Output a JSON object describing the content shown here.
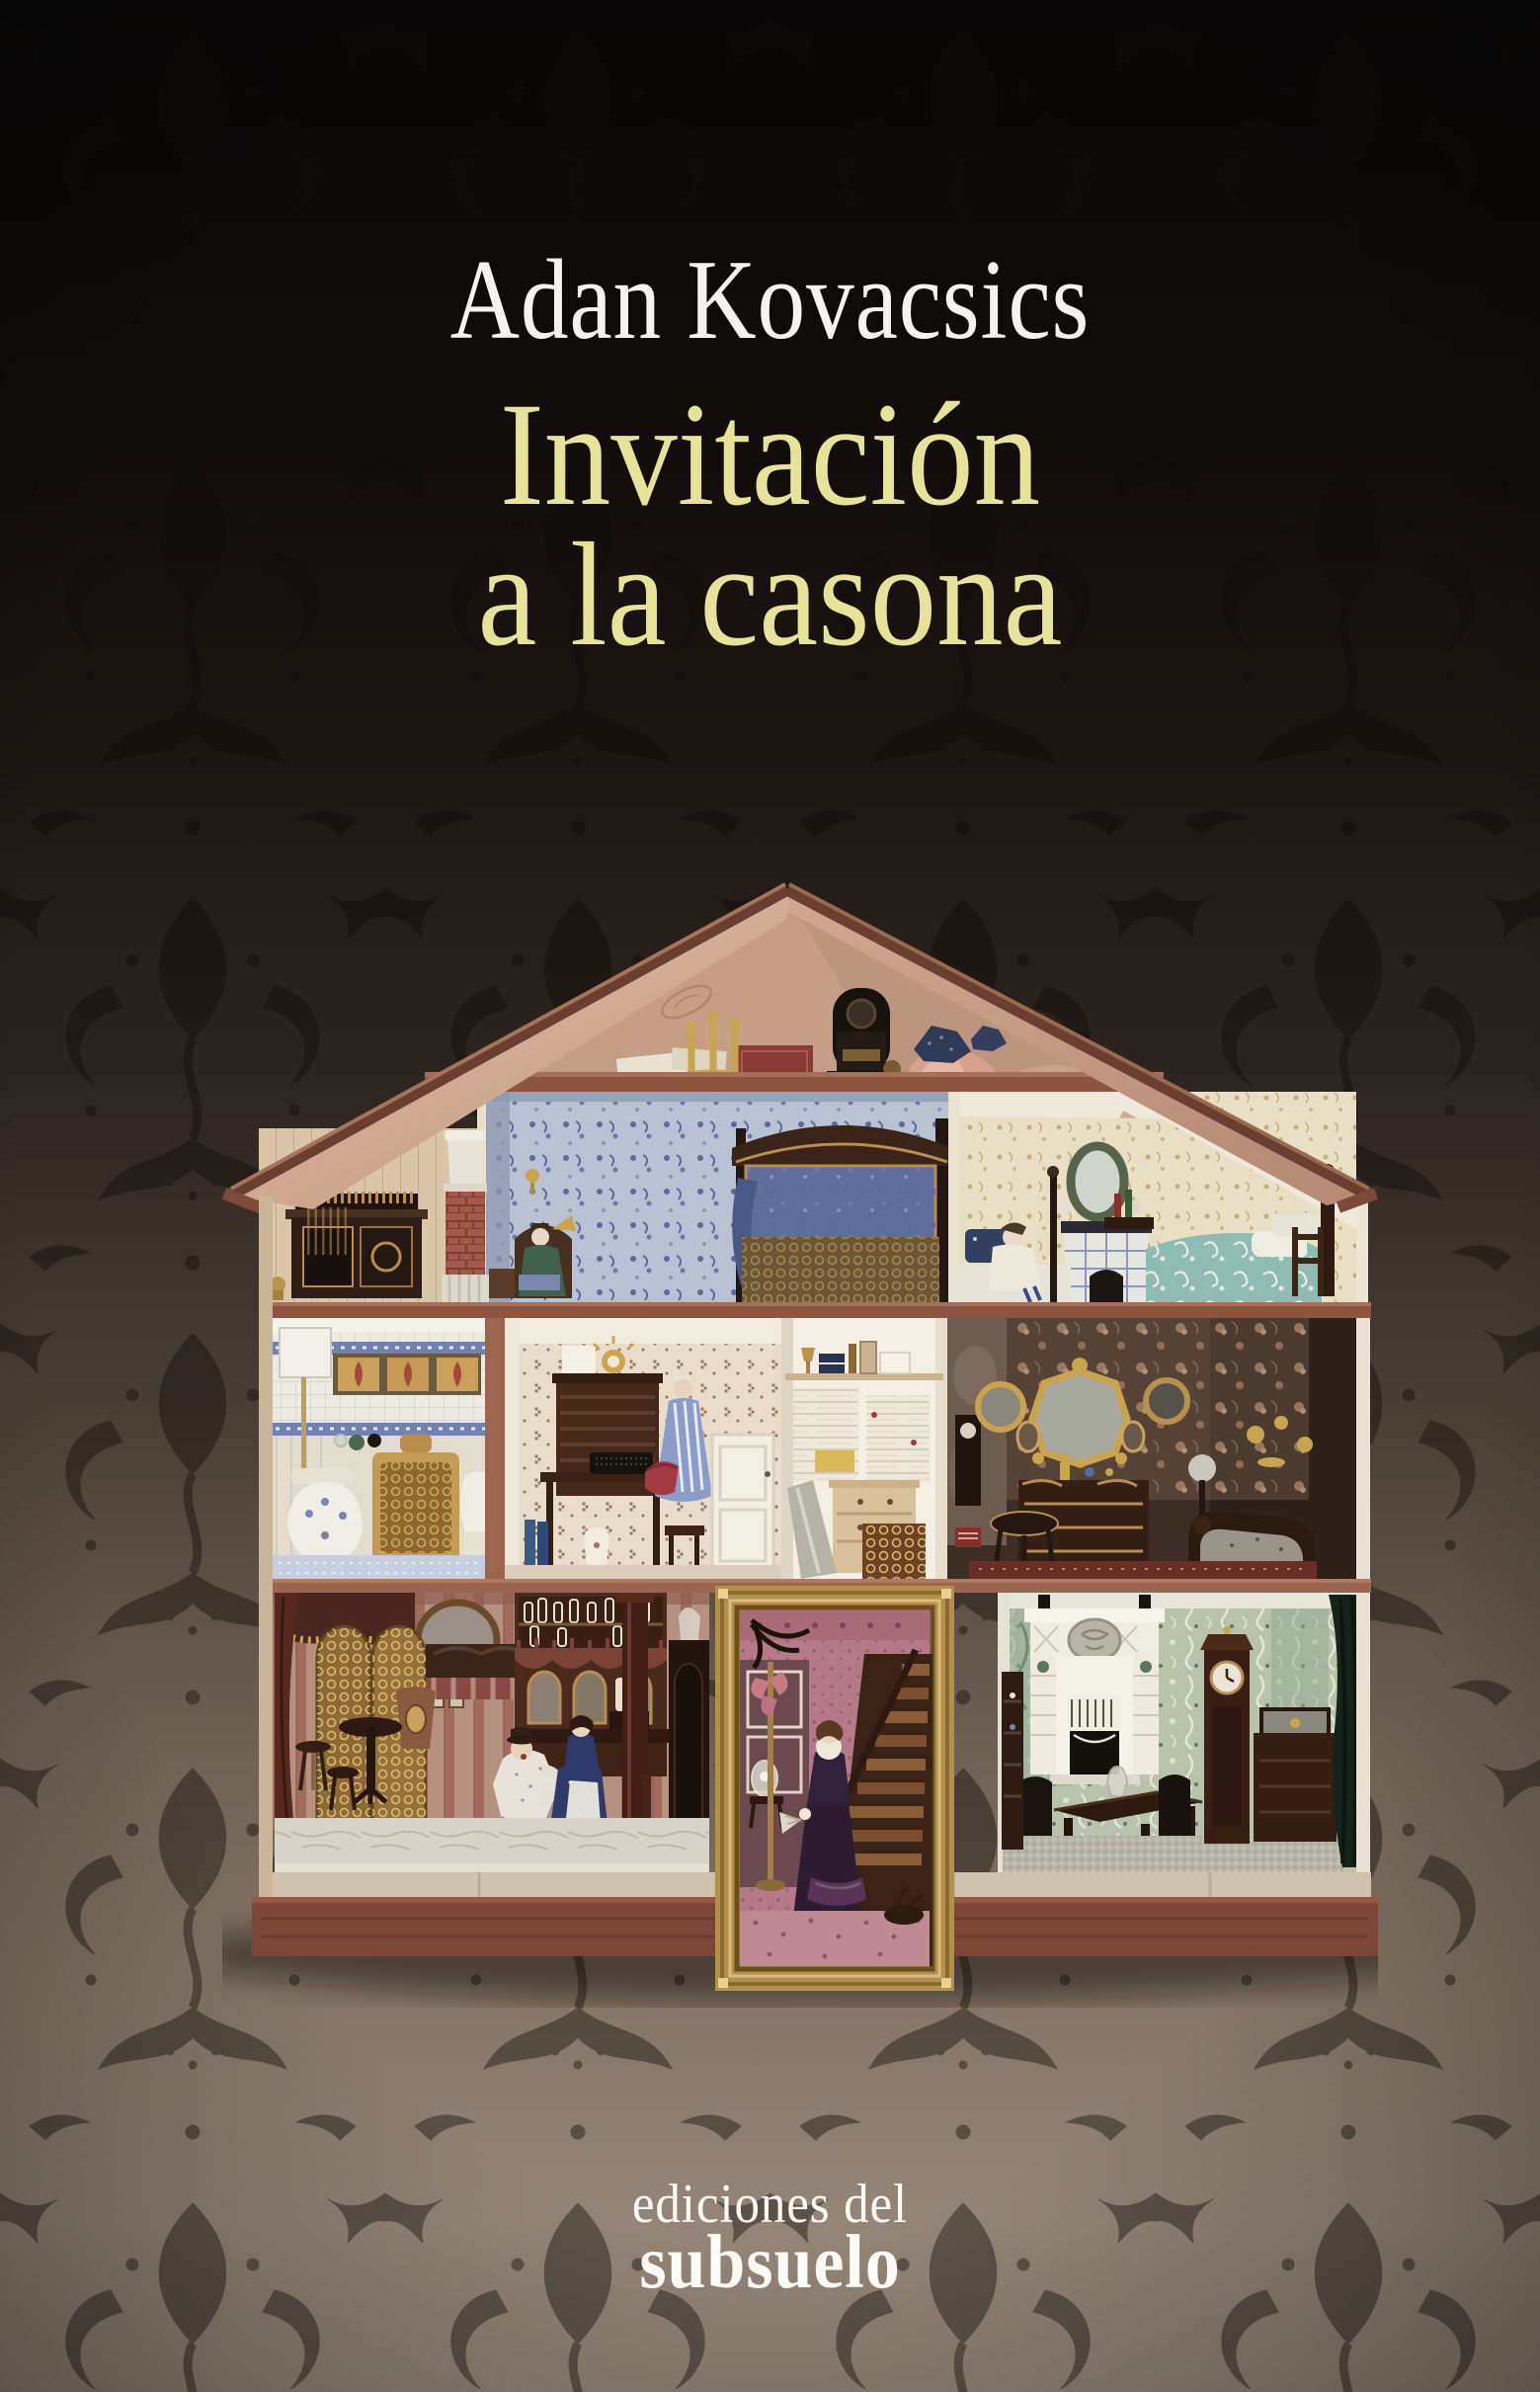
{
  "cover": {
    "author": "Adan Kovacsics",
    "title": {
      "line1": "Invitación",
      "line2": "a la casona"
    },
    "publisher": {
      "line1": "ediciones del",
      "line2": "subsuelo"
    },
    "colors": {
      "title_text": "#e7e29a",
      "author_text": "#f6f3ee",
      "publisher_text": "#fbfaf6",
      "background_top": "#0a0807",
      "background_bottom": "#93877a",
      "roof_wood": "#d5b098",
      "frame_gold": "#c0a05c"
    },
    "artwork": {
      "type": "photograph",
      "subject": "cutaway dollhouse with furnished miniature rooms on damask wallpaper",
      "rooms": [
        "attic store with cabinet and brick chimney",
        "attic bedroom with canopy bed and doll in armchair",
        "attic bedroom with raftered sloped ceiling and teal bed",
        "tiled bathroom with gilt stove",
        "study with bureau, typewriter and doll in striped gown",
        "linen closet",
        "dark boudoir with gilt mirrors and chaise",
        "tavern parlour with bar and two dolls",
        "staircase hall framed in a gilt picture frame with lady doll",
        "dining room with white fireplace and longcase clock"
      ]
    }
  }
}
